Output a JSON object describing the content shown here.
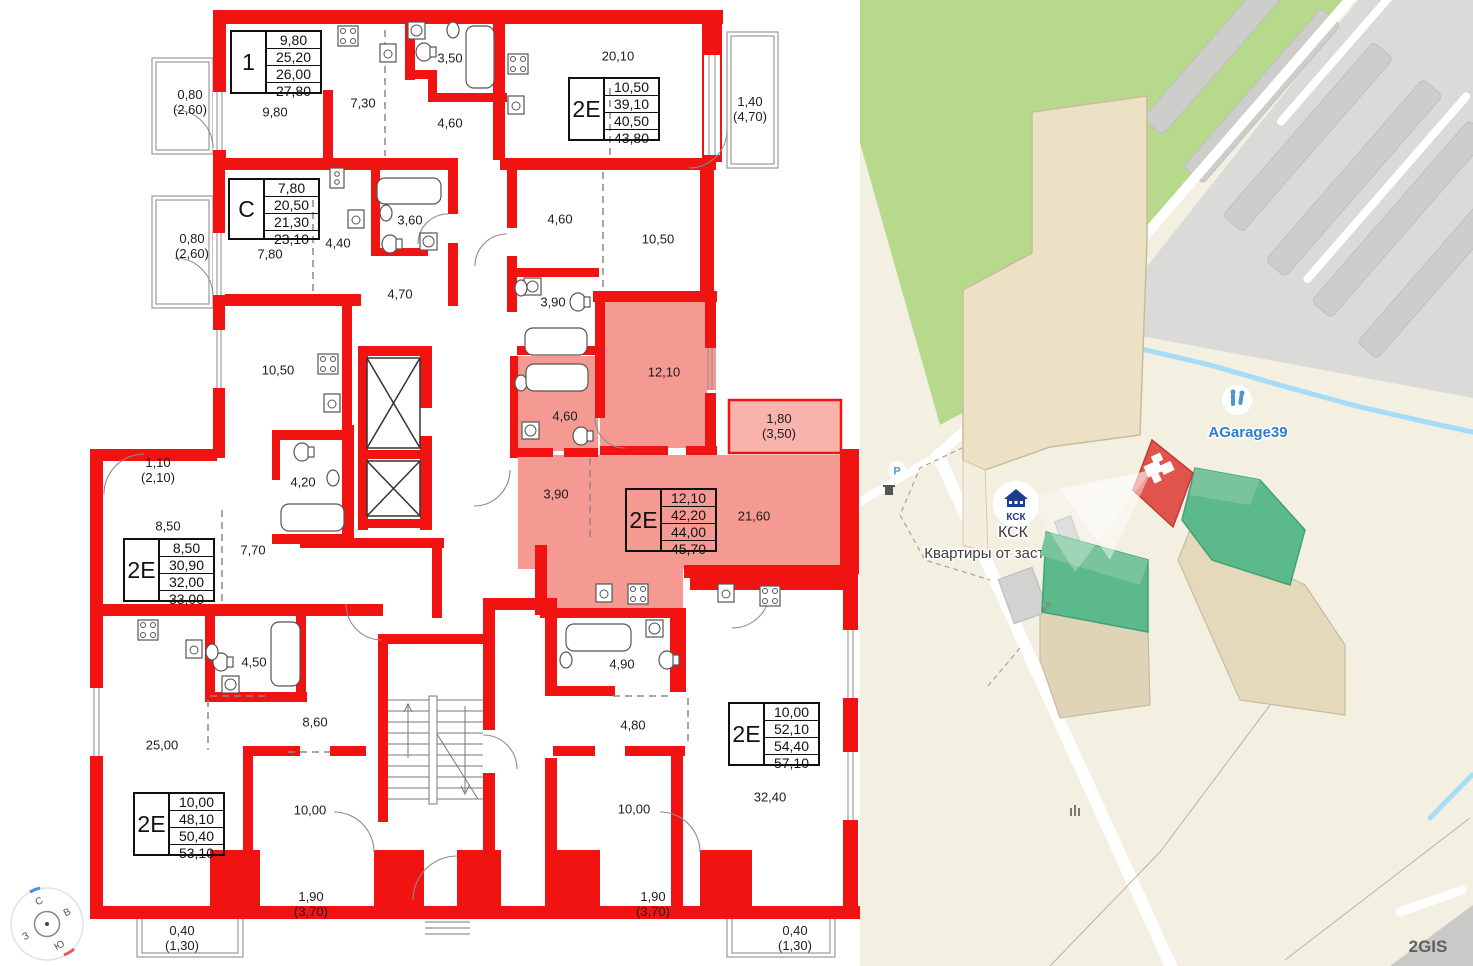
{
  "floorplan": {
    "apartment_tables": [
      {
        "type": "1",
        "values": [
          "9,80",
          "25,20",
          "26,00",
          "27,80"
        ]
      },
      {
        "type": "2Е",
        "values": [
          "10,50",
          "39,10",
          "40,50",
          "43,80"
        ]
      },
      {
        "type": "С",
        "values": [
          "7,80",
          "20,50",
          "21,30",
          "23,10"
        ]
      },
      {
        "type": "2Е",
        "values": [
          "12,10",
          "42,20",
          "44,00",
          "45,70"
        ]
      },
      {
        "type": "2Е",
        "values": [
          "8,50",
          "30,90",
          "32,00",
          "33,00"
        ]
      },
      {
        "type": "2Е",
        "values": [
          "10,00",
          "48,10",
          "50,40",
          "53,10"
        ]
      },
      {
        "type": "2Е",
        "values": [
          "10,00",
          "52,10",
          "54,40",
          "57,10"
        ]
      }
    ],
    "room_labels": [
      "9,80",
      "7,30",
      "3,50",
      "4,60",
      "20,10",
      "0,80\n(2,60)",
      "0,80\n(2,60)",
      "7,80",
      "4,40",
      "3,60",
      "4,70",
      "4,60",
      "10,50",
      "3,90",
      "12,10",
      "4,60",
      "1,80\n(3,50)",
      "3,90",
      "21,60",
      "1,10\n(2,10)",
      "8,50",
      "10,50",
      "4,20",
      "7,70",
      "4,50",
      "8,60",
      "25,00",
      "10,00",
      "4,90",
      "4,80",
      "10,00",
      "32,40",
      "1,90\n(3,70)",
      "1,90\n(3,70)",
      "0,40\n(1,30)",
      "0,40\n(1,30)",
      "1,40\n(4,70)"
    ]
  },
  "compass": {
    "n": "С",
    "e": "В",
    "s": "Ю",
    "w": "З"
  },
  "map": {
    "ksk_logo_text": "КСК",
    "ksk_title": "КСК",
    "ksk_subtitle": "Квартиры от застройщ",
    "garage_label": "AGarage39",
    "parking_label": "Р",
    "floors_label": "9-9",
    "watermark": "2GIS",
    "colors": {
      "wall_red": "#f11212",
      "selected_pink": "#f59a92",
      "map_green_area": "#b7d98b",
      "building_green": "#5cb98b",
      "building_red": "#e0544c",
      "river_blue": "#a6dcf5",
      "label_blue": "#2e7ecb"
    }
  }
}
